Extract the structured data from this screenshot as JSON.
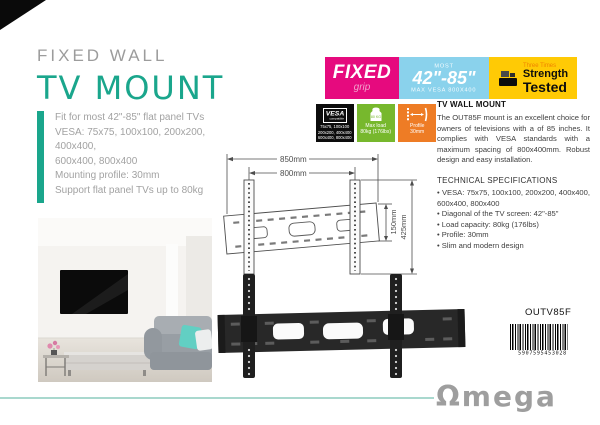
{
  "header": {
    "subtitle": "FIXED WALL",
    "title": "TV MOUNT"
  },
  "features": {
    "lines": [
      "Fit for most 42\"-85\" flat panel TVs",
      "VESA: 75x75, 100x100, 200x200,",
      "400x400,",
      "600x400, 800x400",
      "Mounting profile: 30mm",
      "Support flat panel TVs up to 80kg"
    ]
  },
  "badges": {
    "fixed": {
      "label": "FIXED",
      "sub": "grip"
    },
    "size": {
      "top": "MOST",
      "label": "42\"-85\"",
      "sub": "MAX VESA 800X400"
    },
    "strength": {
      "top": "Three Times",
      "line1": "Strength",
      "line2": "Tested"
    }
  },
  "icon_badges": {
    "vesa": {
      "logo": "VESA",
      "logo_sub": "compatible",
      "lines": [
        "75x75, 100x100",
        "200x200, 400x400",
        "600x400, 800x400"
      ]
    },
    "load": {
      "icon_text": "80 KG",
      "label1": "Max load",
      "label2": "80kg (176lbs)"
    },
    "profile": {
      "label1": "Profile",
      "label2": "30mm"
    }
  },
  "product_info": {
    "heading": "TV WALL MOUNT",
    "description": "The OUT85F mount is an excellent choice for owners of televisions with a of 85 inches. It complies with VESA standards with a maximum spacing of 800x400mm. Robust design and easy installation.",
    "specs_heading": "TECHNICAL SPECIFICATIONS",
    "specs": [
      "VESA: 75x75, 100x100, 200x200, 400x400, 600x400, 800x400",
      "Diagonal of the TV screen: 42\"-85\"",
      "Load capacity: 80kg (176lbs)",
      "Profile: 30mm",
      "Slim and modern design"
    ]
  },
  "diagram": {
    "top_width": "850mm",
    "hole_width": "800mm",
    "bracket_height": "425mm",
    "plate_height": "150mm"
  },
  "footer": {
    "sku": "OUTV85F",
    "barcode_digits": "5907595453028",
    "brand": "Ωmega"
  },
  "colors": {
    "accent_teal": "#1aa68c",
    "magenta": "#e60a7e",
    "light_blue": "#8ad2ec",
    "yellow": "#ffca05",
    "green": "#77b82d",
    "orange": "#ee7c25",
    "gray_text": "#9c9c9c"
  }
}
